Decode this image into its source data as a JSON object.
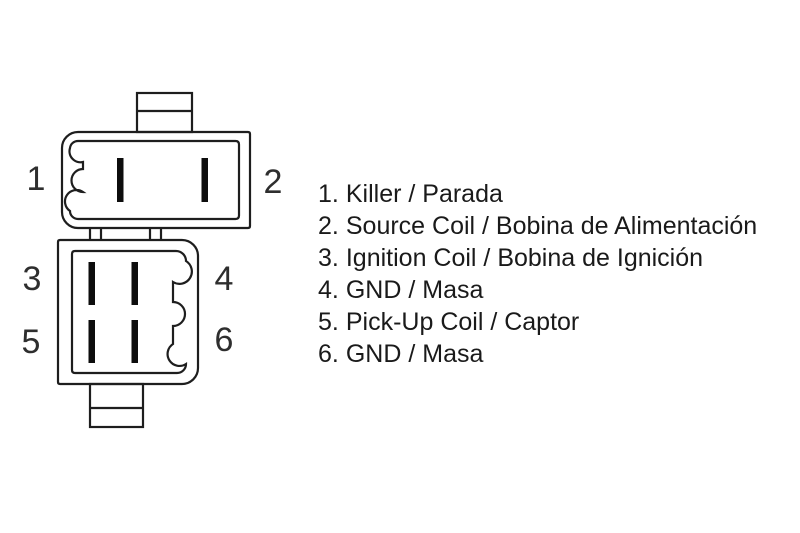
{
  "diagram": {
    "line_color": "#1e1e1e",
    "pin_color": "#0d0d0d",
    "pin_numbers": [
      {
        "num": "1"
      },
      {
        "num": "2"
      },
      {
        "num": "3"
      },
      {
        "num": "4"
      },
      {
        "num": "5"
      },
      {
        "num": "6"
      }
    ]
  },
  "legend": {
    "items": [
      {
        "num": "1.",
        "label": "Killer / Parada"
      },
      {
        "num": "2.",
        "label": "Source Coil / Bobina de Alimentación"
      },
      {
        "num": "3.",
        "label": "Ignition Coil / Bobina de Ignición"
      },
      {
        "num": "4.",
        "label": "GND / Masa"
      },
      {
        "num": "5.",
        "label": "Pick-Up Coil / Captor"
      },
      {
        "num": "6.",
        "label": "GND / Masa"
      }
    ]
  }
}
